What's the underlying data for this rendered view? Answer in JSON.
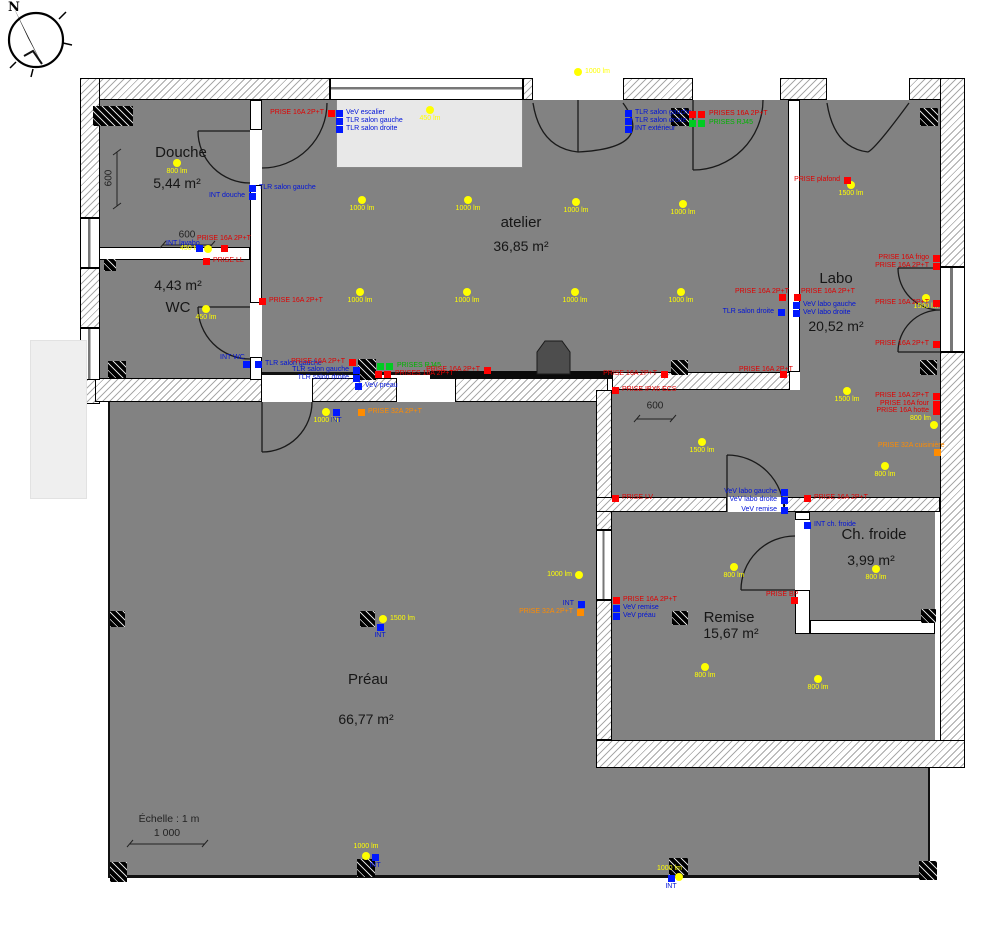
{
  "compass": {
    "label": "N"
  },
  "scale": {
    "label": "Échelle : 1 m",
    "value": "1 000"
  },
  "colors": {
    "room_fill": "#828282",
    "socket_16a": "#ff0000",
    "socket_32a": "#ff8c00",
    "rj45": "#00cc22",
    "switch": "#0018ff",
    "light": "#ffff00"
  },
  "plan": {
    "rooms": [
      {
        "name": "Douche",
        "area": "5,44 m²",
        "nx": 181,
        "ny": 144,
        "ax": 177,
        "ay": 175
      },
      {
        "name": "WC",
        "area": "4,43 m²",
        "nx": 178,
        "ny": 299,
        "ax": 178,
        "ay": 277
      },
      {
        "name": "atelier",
        "area": "36,85 m²",
        "nx": 521,
        "ny": 214,
        "ax": 521,
        "ay": 238
      },
      {
        "name": "Labo",
        "area": "20,52 m²",
        "nx": 836,
        "ny": 270,
        "ax": 836,
        "ay": 318
      },
      {
        "name": "Ch. froide",
        "area": "3,99 m²",
        "nx": 874,
        "ny": 526,
        "ax": 871,
        "ay": 552
      },
      {
        "name": "Remise",
        "area": "15,67 m²",
        "nx": 729,
        "ny": 609,
        "ax": 731,
        "ay": 625
      },
      {
        "name": "Préau",
        "area": "66,77 m²",
        "nx": 368,
        "ny": 671,
        "ax": 366,
        "ay": 711
      }
    ],
    "dims": [
      {
        "label": "600",
        "x": 109,
        "y": 178,
        "vertical": true
      },
      {
        "label": "600",
        "x": 187,
        "y": 235
      },
      {
        "label": "600",
        "x": 655,
        "y": 406
      }
    ],
    "lights": [
      {
        "x": 177,
        "y": 163,
        "label": "800 lm",
        "side": "below"
      },
      {
        "x": 208,
        "y": 249,
        "label": "450 lm",
        "side": "left"
      },
      {
        "x": 206,
        "y": 309,
        "label": "450 lm",
        "side": "below"
      },
      {
        "x": 430,
        "y": 110,
        "label": "450 lm",
        "side": "below"
      },
      {
        "x": 578,
        "y": 72,
        "label": "1000 lm",
        "side": "right"
      },
      {
        "x": 362,
        "y": 200,
        "label": "1000 lm",
        "side": "below"
      },
      {
        "x": 468,
        "y": 200,
        "label": "1000 lm",
        "side": "below"
      },
      {
        "x": 576,
        "y": 202,
        "label": "1000 lm",
        "side": "below"
      },
      {
        "x": 683,
        "y": 204,
        "label": "1000 lm",
        "side": "below"
      },
      {
        "x": 360,
        "y": 292,
        "label": "1000 lm",
        "side": "below"
      },
      {
        "x": 467,
        "y": 292,
        "label": "1000 lm",
        "side": "below"
      },
      {
        "x": 575,
        "y": 292,
        "label": "1000 lm",
        "side": "below"
      },
      {
        "x": 681,
        "y": 292,
        "label": "1000 lm",
        "side": "below"
      },
      {
        "x": 851,
        "y": 185,
        "label": "1500 lm",
        "side": "below"
      },
      {
        "x": 926,
        "y": 298,
        "label": "1500 lm",
        "side": "below"
      },
      {
        "x": 847,
        "y": 391,
        "label": "1500 lm",
        "side": "below"
      },
      {
        "x": 702,
        "y": 442,
        "label": "1500 lm",
        "side": "below"
      },
      {
        "x": 934,
        "y": 425,
        "label": "800 lm",
        "lx": 910,
        "ly": 418
      },
      {
        "x": 885,
        "y": 466,
        "label": "800 lm",
        "side": "below"
      },
      {
        "x": 734,
        "y": 567,
        "label": "800 lm",
        "side": "below"
      },
      {
        "x": 705,
        "y": 667,
        "label": "800 lm",
        "side": "below"
      },
      {
        "x": 818,
        "y": 679,
        "label": "800 lm",
        "side": "below"
      },
      {
        "x": 876,
        "y": 569,
        "label": "800 lm",
        "side": "below"
      },
      {
        "x": 326,
        "y": 412,
        "label": "1000 lm",
        "side": "below"
      },
      {
        "x": 383,
        "y": 619,
        "label": "1500 lm",
        "side": "right"
      },
      {
        "x": 579,
        "y": 575,
        "label": "1000 lm",
        "side": "left"
      },
      {
        "x": 366,
        "y": 856,
        "label": "1000 lm",
        "side": "above"
      },
      {
        "x": 679,
        "y": 877,
        "label": "1000 lm",
        "lx": 657,
        "ly": 868
      }
    ],
    "devices": [
      {
        "kind": "prise",
        "x": 331,
        "y": 113,
        "label": "PRISE 16A 2P+T",
        "side": "left"
      },
      {
        "kind": "switch",
        "x": 339,
        "y": 113,
        "label": "VeV escalier",
        "side": "right"
      },
      {
        "kind": "switch",
        "x": 339,
        "y": 121,
        "label": "TLR salon gauche",
        "side": "right"
      },
      {
        "kind": "switch",
        "x": 339,
        "y": 129,
        "label": "TLR salon droite",
        "side": "right"
      },
      {
        "kind": "switch",
        "x": 252,
        "y": 188,
        "label": "TLR salon gauche",
        "side": "right"
      },
      {
        "kind": "switch",
        "x": 252,
        "y": 196,
        "label": "INT douche",
        "side": "left"
      },
      {
        "kind": "switch",
        "x": 199,
        "y": 248,
        "label": "INT lavabo",
        "lx": 166,
        "ly": 243
      },
      {
        "kind": "prise",
        "x": 224,
        "y": 248,
        "label": "PRISE 16A 2P+T",
        "side": "above"
      },
      {
        "kind": "prise",
        "x": 206,
        "y": 261,
        "label": "PRISE LL",
        "side": "right"
      },
      {
        "kind": "prise",
        "x": 262,
        "y": 301,
        "label": "PRISE 16A 2P+T",
        "side": "right"
      },
      {
        "kind": "switch",
        "x": 246,
        "y": 364,
        "label": "INT WC",
        "lx": 220,
        "ly": 357
      },
      {
        "kind": "switch",
        "x": 258,
        "y": 364,
        "label": "TLR salon gauche",
        "side": "right"
      },
      {
        "kind": "prise",
        "x": 352,
        "y": 362,
        "label": "PRISE 16A 2P+T",
        "side": "left"
      },
      {
        "kind": "switch",
        "x": 356,
        "y": 370,
        "label": "TLR salon gauche",
        "side": "left"
      },
      {
        "kind": "switch",
        "x": 356,
        "y": 378,
        "label": "TLR salon droite",
        "side": "left"
      },
      {
        "kind": "switch",
        "x": 358,
        "y": 386,
        "label": "VeV préau",
        "side": "right"
      },
      {
        "kind": "rj452",
        "x": 385,
        "y": 366,
        "label": "PRISES RJ45",
        "side": "right"
      },
      {
        "kind": "prise2",
        "x": 383,
        "y": 374,
        "label": "PRISES 16A 2P+T",
        "side": "right"
      },
      {
        "kind": "prise",
        "x": 487,
        "y": 370,
        "label": "PRISE 16A 2P+T",
        "side": "left"
      },
      {
        "kind": "switch",
        "x": 628,
        "y": 113,
        "label": "TLR salon gauche",
        "side": "right"
      },
      {
        "kind": "switch",
        "x": 628,
        "y": 121,
        "label": "TLR salon droite",
        "side": "right"
      },
      {
        "kind": "switch",
        "x": 628,
        "y": 129,
        "label": "INT extérieur",
        "side": "right"
      },
      {
        "kind": "prise2",
        "x": 697,
        "y": 114,
        "label": "PRISES 16A 2P+T",
        "side": "right"
      },
      {
        "kind": "rj452",
        "x": 697,
        "y": 123,
        "label": "PRISES RJ45",
        "side": "right"
      },
      {
        "kind": "prise",
        "x": 664,
        "y": 374,
        "label": "PRISE 16A 2P+T",
        "side": "left"
      },
      {
        "kind": "prise",
        "x": 783,
        "y": 374,
        "label": "PRISE 16A 2P+T",
        "lx": 739,
        "ly": 369
      },
      {
        "kind": "prise",
        "x": 847,
        "y": 180,
        "label": "PRISE plafond",
        "side": "left"
      },
      {
        "kind": "prise",
        "x": 936,
        "y": 258,
        "label": "PRISE 16A frigo",
        "side": "left"
      },
      {
        "kind": "prise",
        "x": 936,
        "y": 266,
        "label": "PRISE 16A 2P+T",
        "side": "left"
      },
      {
        "kind": "prise",
        "x": 936,
        "y": 303,
        "label": "PRISE 16A 2P+T",
        "side": "left"
      },
      {
        "kind": "prise",
        "x": 936,
        "y": 344,
        "label": "PRISE 16A 2P+T",
        "side": "left"
      },
      {
        "kind": "prise",
        "x": 782,
        "y": 297,
        "label": "PRISE 16A 2P+T",
        "lx": 735,
        "ly": 291
      },
      {
        "kind": "prise",
        "x": 797,
        "y": 297,
        "label": "PRISE 16A 2P+T",
        "lx": 801,
        "ly": 291
      },
      {
        "kind": "switch",
        "x": 781,
        "y": 312,
        "label": "TLR salon droite",
        "side": "left"
      },
      {
        "kind": "switch",
        "x": 796,
        "y": 305,
        "label": "VeV labo gauche",
        "side": "right"
      },
      {
        "kind": "switch",
        "x": 796,
        "y": 313,
        "label": "VeV labo droite",
        "side": "right"
      },
      {
        "kind": "prise",
        "x": 615,
        "y": 390,
        "label": "PRISE IPX6 ECS",
        "side": "right"
      },
      {
        "kind": "prise",
        "x": 936,
        "y": 396,
        "label": "PRISE 16A 2P+T",
        "side": "left"
      },
      {
        "kind": "prise",
        "x": 936,
        "y": 404,
        "label": "PRISE 16A four",
        "side": "left"
      },
      {
        "kind": "prise",
        "x": 936,
        "y": 411,
        "label": "PRISE 16A hotte",
        "side": "left"
      },
      {
        "kind": "prise32",
        "x": 937,
        "y": 452,
        "label": "PRISE 32A cuisinière",
        "lx": 878,
        "ly": 445
      },
      {
        "kind": "switch",
        "x": 784,
        "y": 492,
        "label": "VeV labo gauche",
        "side": "left"
      },
      {
        "kind": "switch",
        "x": 784,
        "y": 500,
        "label": "VeV labo droite",
        "side": "left"
      },
      {
        "kind": "switch",
        "x": 784,
        "y": 510,
        "label": "VeV remise",
        "side": "left"
      },
      {
        "kind": "prise",
        "x": 615,
        "y": 498,
        "label": "PRISE LV",
        "side": "right"
      },
      {
        "kind": "prise",
        "x": 807,
        "y": 498,
        "label": "PRISE 16A 2P+T",
        "side": "right"
      },
      {
        "kind": "prise",
        "x": 616,
        "y": 600,
        "label": "PRISE 16A 2P+T",
        "side": "right"
      },
      {
        "kind": "switch",
        "x": 616,
        "y": 608,
        "label": "VeV remise",
        "side": "right"
      },
      {
        "kind": "switch",
        "x": 616,
        "y": 616,
        "label": "VeV préau",
        "side": "right"
      },
      {
        "kind": "switch",
        "x": 581,
        "y": 604,
        "label": "INT",
        "side": "left"
      },
      {
        "kind": "prise32",
        "x": 580,
        "y": 612,
        "label": "PRISE 32A 2P+T",
        "side": "left"
      },
      {
        "kind": "prise",
        "x": 794,
        "y": 600,
        "label": "PRISE BP",
        "lx": 766,
        "ly": 594
      },
      {
        "kind": "switch",
        "x": 807,
        "y": 525,
        "label": "INT ch. froide",
        "side": "right"
      },
      {
        "kind": "prise32",
        "x": 361,
        "y": 412,
        "label": "PRISE 32A 2P+T",
        "side": "right"
      },
      {
        "kind": "switch",
        "x": 336,
        "y": 412,
        "label": "INT",
        "side": "below"
      },
      {
        "kind": "switch",
        "x": 380,
        "y": 627,
        "label": "INT",
        "side": "below"
      },
      {
        "kind": "switch",
        "x": 375,
        "y": 857,
        "label": "INT",
        "side": "below"
      },
      {
        "kind": "switch",
        "x": 671,
        "y": 878,
        "label": "INT",
        "side": "below"
      }
    ]
  }
}
